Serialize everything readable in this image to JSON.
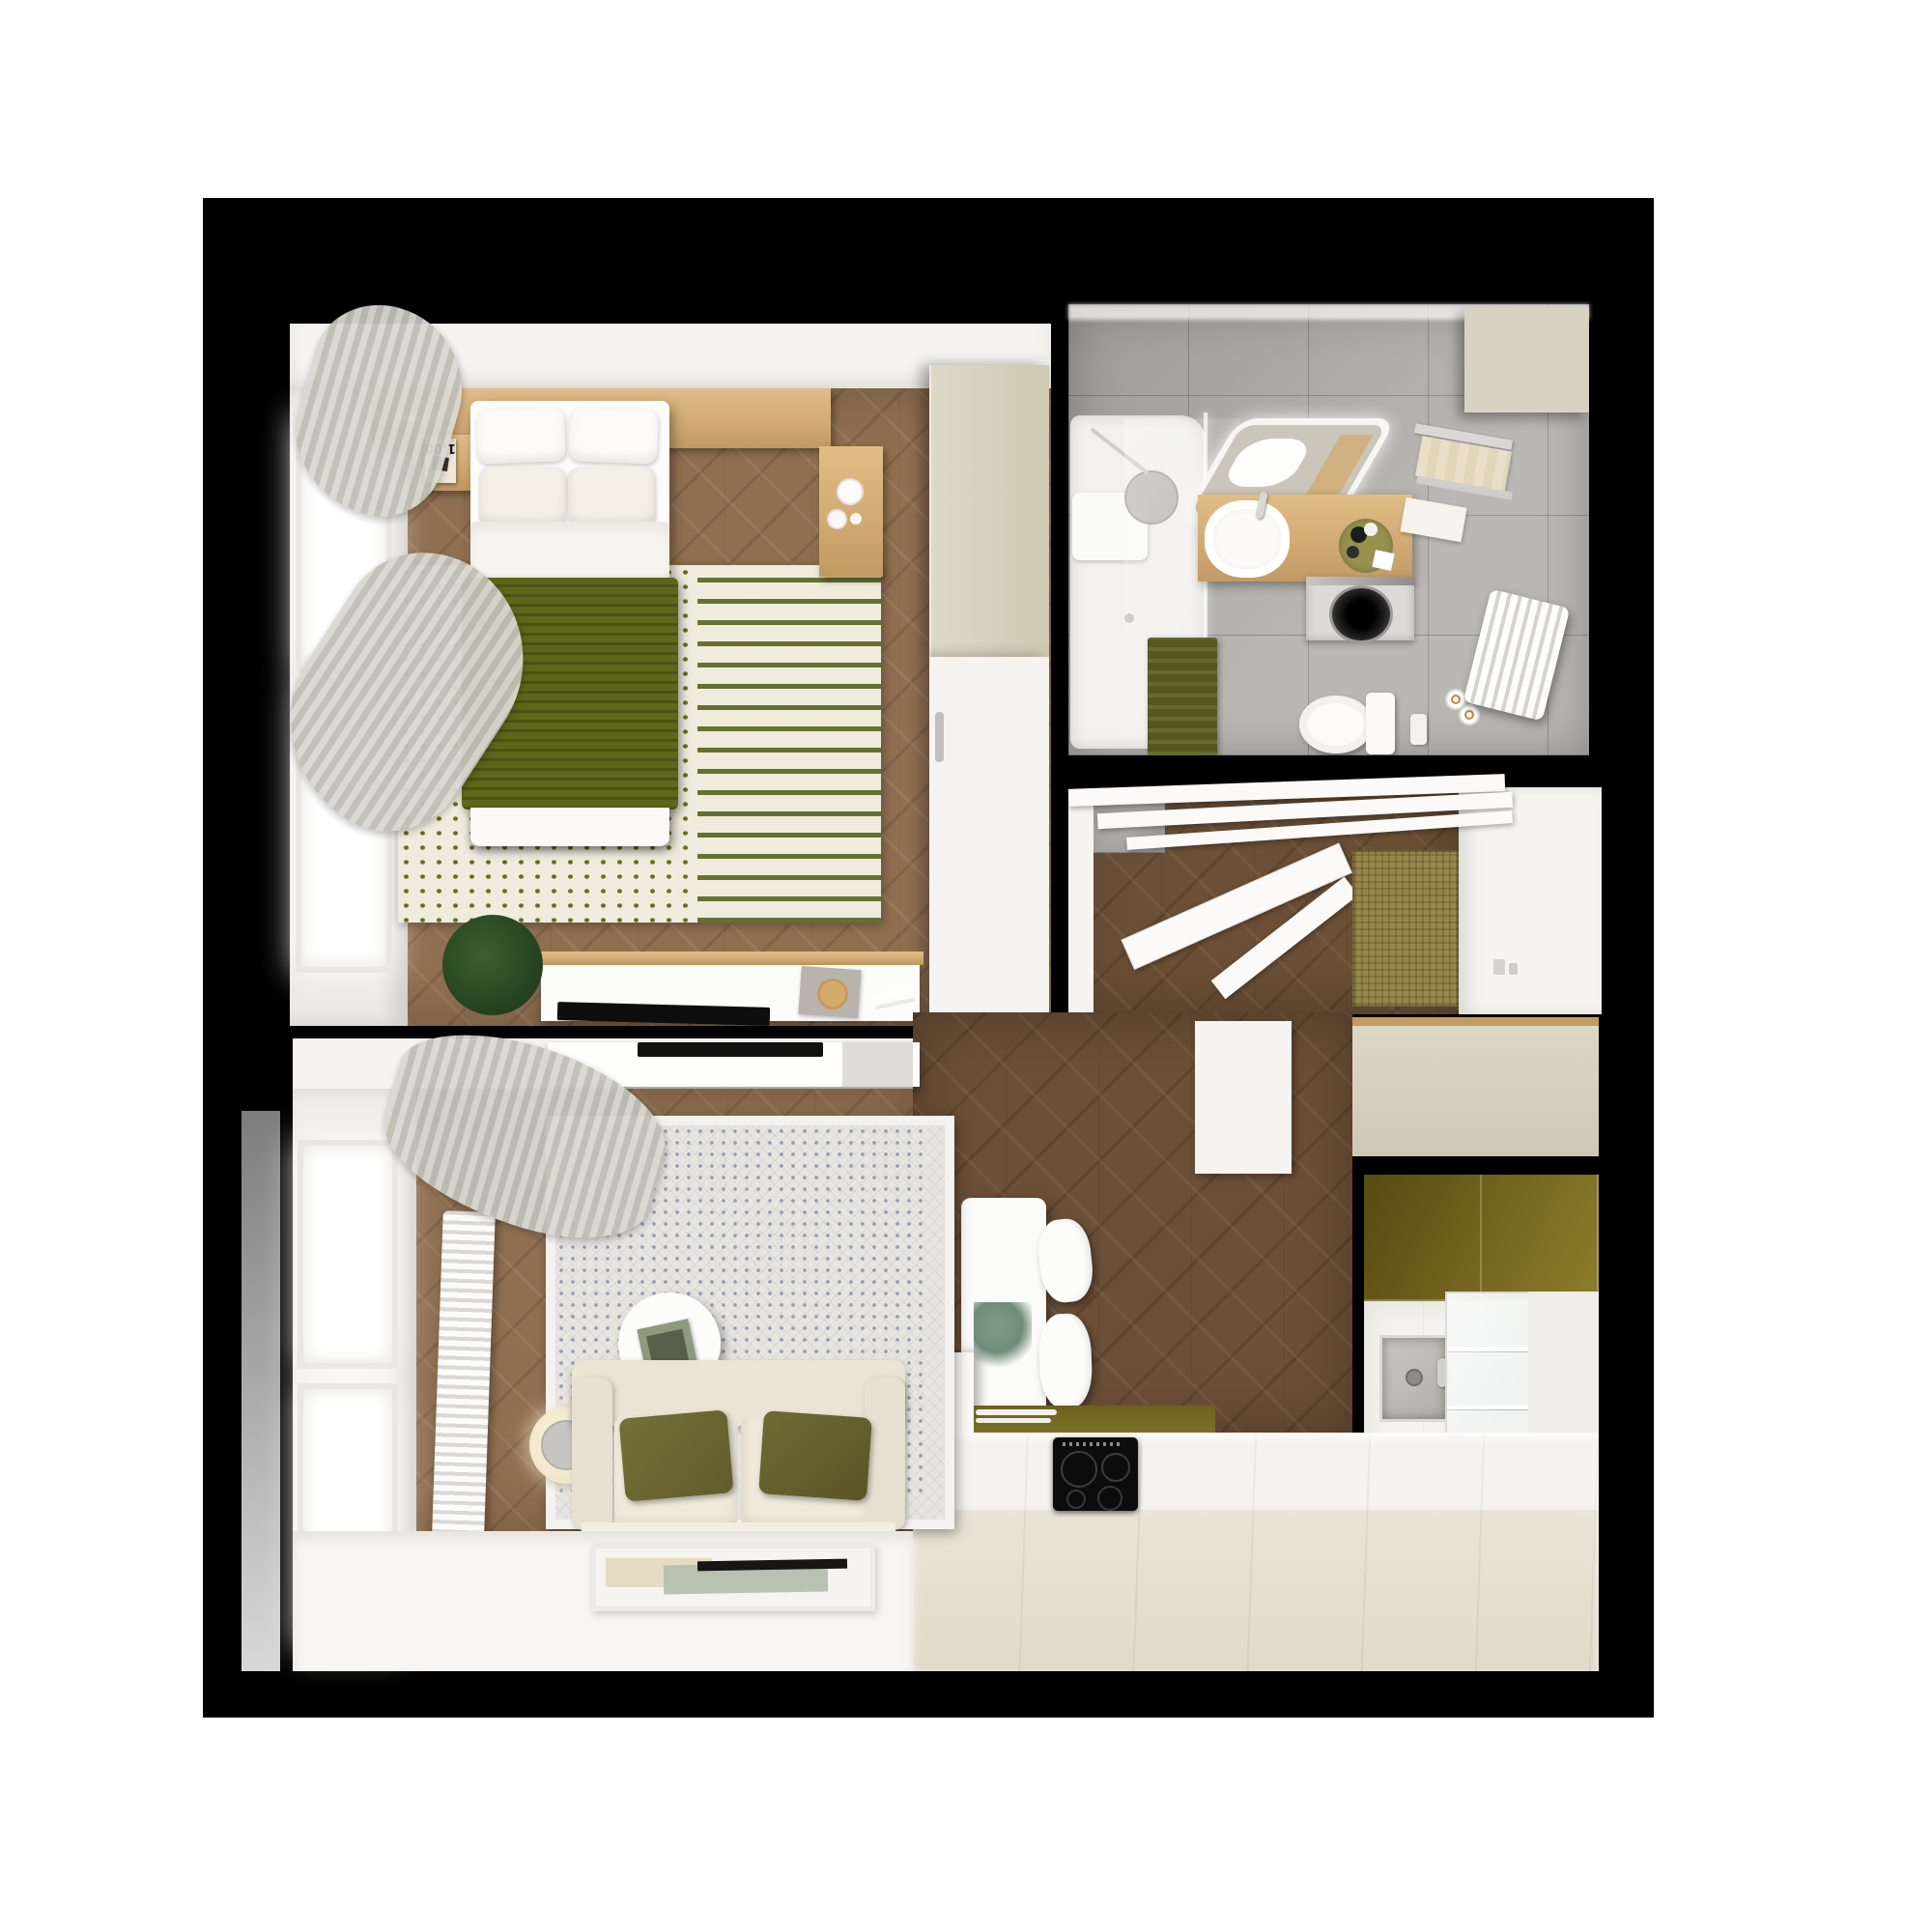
{
  "scene": {
    "type": "top-down 3D apartment floor plan render",
    "title": "Studio apartment 3D floor plan",
    "rooms": [
      {
        "name": "bedroom",
        "furniture": [
          "headboard-shelf",
          "bed",
          "pillows",
          "green-blanket",
          "dotted-rug",
          "nightstand-left",
          "nightstand-right",
          "book",
          "wardrobe",
          "closet-door",
          "tv-console",
          "tv",
          "plant",
          "window-bay",
          "curtains"
        ]
      },
      {
        "name": "bathroom",
        "furniture": [
          "shower-tray",
          "glass-partition",
          "shower-head",
          "led-mirror",
          "vanity-counter",
          "sink",
          "towel-rack",
          "washing-machine",
          "bath-mat",
          "toilet",
          "flush-plate",
          "toilet-paper-holder",
          "radiator",
          "storage-top"
        ]
      },
      {
        "name": "hallway",
        "furniture": [
          "entrance-door-open",
          "door-beams",
          "jute-doormat",
          "right-wall",
          "light-switches"
        ]
      },
      {
        "name": "kitchen",
        "furniture": [
          "tall-unit-top",
          "olive-upper-cabinets",
          "steel-sink",
          "glass-front-cabinet",
          "counter",
          "induction-hob",
          "olive-base-strip",
          "dining-table",
          "dining-chairs",
          "table-plant",
          "partition-wall"
        ]
      },
      {
        "name": "living-room",
        "furniture": [
          "tv-cabinet",
          "wall-tv",
          "window-bay",
          "radiator",
          "curtain",
          "patterned-rug",
          "sofa",
          "olive-pillows",
          "side-table",
          "magazine",
          "floor-lamp",
          "floor-art"
        ]
      }
    ]
  },
  "text": {
    "book_cover": "1.00"
  },
  "palette": {
    "page": "#ffffff",
    "photo": "#000000",
    "wood_light": "#8f6f50",
    "wood_dark": "#6b4f36",
    "tile": "#b6b3af",
    "white": "#f5f4f1",
    "oak": "#d2ab74",
    "olive_cabinet": "#6f6320",
    "beige_cabinet": "#d5cfbd",
    "counter": "#e6e1d2",
    "green_blanket": "#5d671a",
    "olive_pillow": "#6b6530",
    "bath_mat": "#55571c",
    "jute": "#96874a",
    "sofa": "#ece4d6",
    "rug_bedroom": "#f0ecdd",
    "rug_living": "#e7e5e0",
    "curtain": "#cfcfc7"
  }
}
